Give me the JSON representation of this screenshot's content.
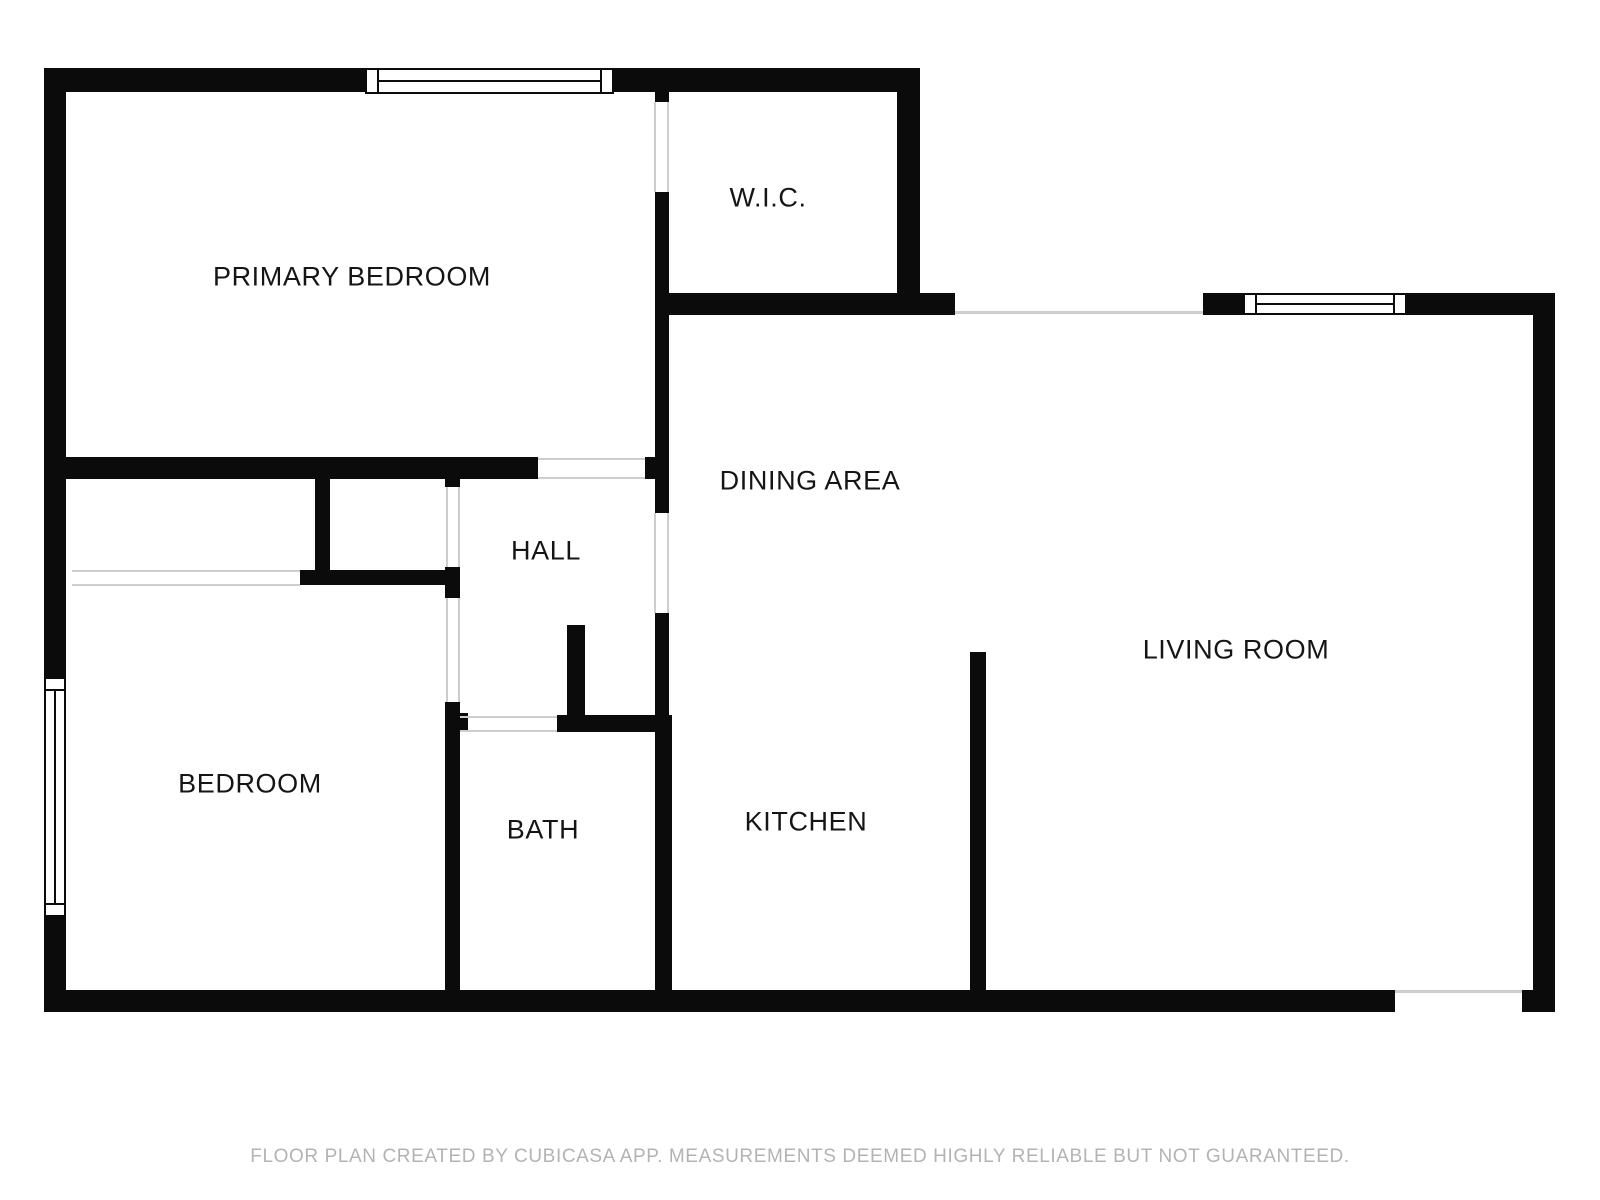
{
  "colors": {
    "wall": "#0b0b0b",
    "opening_line": "#cdcdcd",
    "label_text": "#151515",
    "footer_text": "#b3b3b3",
    "background": "#ffffff"
  },
  "rooms": [
    {
      "label": "PRIMARY BEDROOM",
      "x": 352,
      "y": 277
    },
    {
      "label": "W.I.C.",
      "x": 768,
      "y": 198
    },
    {
      "label": "DINING AREA",
      "x": 810,
      "y": 481
    },
    {
      "label": "HALL",
      "x": 546,
      "y": 551
    },
    {
      "label": "LIVING ROOM",
      "x": 1236,
      "y": 650
    },
    {
      "label": "BEDROOM",
      "x": 250,
      "y": 784
    },
    {
      "label": "BATH",
      "x": 543,
      "y": 830
    },
    {
      "label": "KITCHEN",
      "x": 806,
      "y": 822
    }
  ],
  "footer": {
    "text": "FLOOR PLAN CREATED BY CUBICASA APP. MEASUREMENTS DEEMED HIGHLY RELIABLE BUT NOT GUARANTEED."
  },
  "geometry": {
    "walls": [
      {
        "name": "top-wall-left-segment",
        "x": 44,
        "y": 68,
        "w": 321,
        "h": 24
      },
      {
        "name": "top-wall-right-segment",
        "x": 614,
        "y": 68,
        "w": 303,
        "h": 24
      },
      {
        "name": "wic-right-wall",
        "x": 897,
        "y": 68,
        "w": 23,
        "h": 247
      },
      {
        "name": "wic-bottom-wall",
        "x": 655,
        "y": 293,
        "w": 300,
        "h": 22
      },
      {
        "name": "living-top-wall-left",
        "x": 1203,
        "y": 293,
        "w": 40,
        "h": 22
      },
      {
        "name": "living-top-wall-right",
        "x": 1407,
        "y": 293,
        "w": 148,
        "h": 22
      },
      {
        "name": "right-exterior-wall",
        "x": 1533,
        "y": 293,
        "w": 22,
        "h": 719
      },
      {
        "name": "bottom-exterior-wall",
        "x": 44,
        "y": 990,
        "w": 1351,
        "h": 22
      },
      {
        "name": "bottom-right-corner-wall",
        "x": 1522,
        "y": 990,
        "w": 33,
        "h": 22
      },
      {
        "name": "left-exterior-wall-upper",
        "x": 44,
        "y": 68,
        "w": 22,
        "h": 609
      },
      {
        "name": "left-exterior-wall-lower",
        "x": 44,
        "y": 917,
        "w": 22,
        "h": 95
      },
      {
        "name": "wic-left-wall-stub",
        "x": 655,
        "y": 92,
        "w": 14,
        "h": 10
      },
      {
        "name": "wic-left-wall-lower",
        "x": 655,
        "y": 192,
        "w": 14,
        "h": 101
      },
      {
        "name": "bedroom-dining-divider",
        "x": 655,
        "y": 315,
        "w": 14,
        "h": 142
      },
      {
        "name": "primary-bedroom-bottom-wall",
        "x": 44,
        "y": 457,
        "w": 494,
        "h": 22
      },
      {
        "name": "primary-bedroom-bottom-corner",
        "x": 645,
        "y": 457,
        "w": 24,
        "h": 22
      },
      {
        "name": "hall-dining-wall-upper",
        "x": 655,
        "y": 479,
        "w": 14,
        "h": 34
      },
      {
        "name": "hall-dining-wall-lower",
        "x": 655,
        "y": 613,
        "w": 14,
        "h": 102
      },
      {
        "name": "bath-right-wall",
        "x": 655,
        "y": 715,
        "w": 17,
        "h": 275
      },
      {
        "name": "bath-top-wall",
        "x": 557,
        "y": 715,
        "w": 115,
        "h": 17
      },
      {
        "name": "hall-alcove-stub-wall",
        "x": 567,
        "y": 625,
        "w": 18,
        "h": 90
      },
      {
        "name": "closet-divider-wall",
        "x": 315,
        "y": 479,
        "w": 15,
        "h": 91
      },
      {
        "name": "closet-bottom-wall",
        "x": 300,
        "y": 570,
        "w": 157,
        "h": 15
      },
      {
        "name": "hall-closet-door-stub",
        "x": 445,
        "y": 479,
        "w": 15,
        "h": 8
      },
      {
        "name": "hall-wall-between-doors",
        "x": 445,
        "y": 567,
        "w": 15,
        "h": 31
      },
      {
        "name": "bedroom-bath-wall",
        "x": 445,
        "y": 702,
        "w": 15,
        "h": 288
      },
      {
        "name": "bath-door-nub",
        "x": 458,
        "y": 713,
        "w": 10,
        "h": 17
      },
      {
        "name": "kitchen-living-divider",
        "x": 970,
        "y": 652,
        "w": 16,
        "h": 338
      }
    ],
    "openings": [
      {
        "name": "entry-opening-line",
        "x": 955,
        "y": 311,
        "w": 248,
        "h": 3
      },
      {
        "name": "patio-opening-line",
        "x": 1395,
        "y": 990,
        "w": 127,
        "h": 3
      },
      {
        "name": "wic-door-line-a",
        "x": 654,
        "y": 102,
        "w": 2,
        "h": 90
      },
      {
        "name": "wic-door-line-b",
        "x": 667,
        "y": 102,
        "w": 2,
        "h": 90
      },
      {
        "name": "primary-bedroom-door-line-a",
        "x": 538,
        "y": 458,
        "w": 107,
        "h": 2
      },
      {
        "name": "primary-bedroom-door-line-b",
        "x": 538,
        "y": 477,
        "w": 107,
        "h": 2
      },
      {
        "name": "hall-dining-door-line-a",
        "x": 654,
        "y": 513,
        "w": 2,
        "h": 100
      },
      {
        "name": "hall-dining-door-line-b",
        "x": 667,
        "y": 513,
        "w": 2,
        "h": 100
      },
      {
        "name": "hall-closet-door-line-a",
        "x": 446,
        "y": 487,
        "w": 2,
        "h": 80
      },
      {
        "name": "hall-closet-door-line-b",
        "x": 458,
        "y": 487,
        "w": 2,
        "h": 80
      },
      {
        "name": "bedroom-door-line-a",
        "x": 446,
        "y": 598,
        "w": 2,
        "h": 104
      },
      {
        "name": "bedroom-door-line-b",
        "x": 458,
        "y": 598,
        "w": 2,
        "h": 104
      },
      {
        "name": "bath-door-line-a",
        "x": 460,
        "y": 716,
        "w": 97,
        "h": 2
      },
      {
        "name": "bath-door-line-b",
        "x": 460,
        "y": 730,
        "w": 97,
        "h": 2
      },
      {
        "name": "closet-sliding-door-line-a",
        "x": 72,
        "y": 570,
        "w": 228,
        "h": 2
      },
      {
        "name": "closet-sliding-door-line-b",
        "x": 72,
        "y": 584,
        "w": 228,
        "h": 2
      }
    ],
    "windows": [
      {
        "name": "primary-bedroom-window",
        "x": 365,
        "y": 68,
        "w": 249,
        "h": 26,
        "orientation": "h"
      },
      {
        "name": "living-room-window",
        "x": 1243,
        "y": 293,
        "w": 164,
        "h": 22,
        "orientation": "h"
      },
      {
        "name": "bedroom-window",
        "x": 44,
        "y": 677,
        "w": 22,
        "h": 240,
        "orientation": "v"
      }
    ]
  }
}
